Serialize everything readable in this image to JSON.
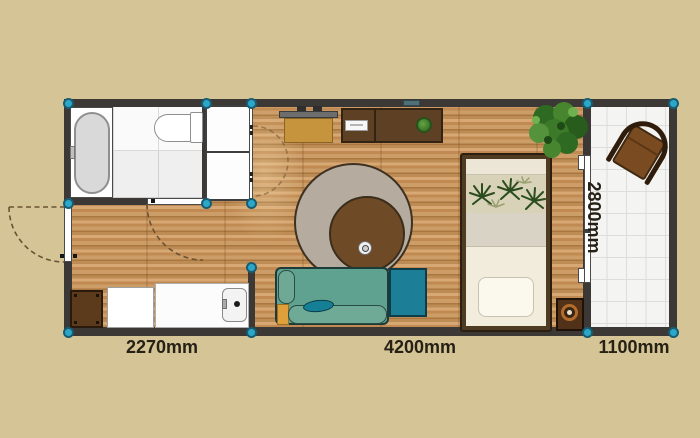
{
  "floor_plan": {
    "dimension_labels": {
      "left_section_width": "2270mm",
      "middle_section_width": "4200mm",
      "right_section_width": "1100mm",
      "plan_depth": "2800mm"
    },
    "colors": {
      "background": "#d4c496",
      "wall": "#3b3835",
      "corner_node": "#2da7c7",
      "wood_floor": "#c5925c",
      "sofa": "#5fa28f",
      "ottoman": "#1d7e97",
      "rug_outer": "#b5ab9e",
      "rug_inner": "#6f4a26",
      "dark_wood_furniture": "#5e4124",
      "desk": "#c7943e",
      "label_text": "#262015"
    }
  }
}
